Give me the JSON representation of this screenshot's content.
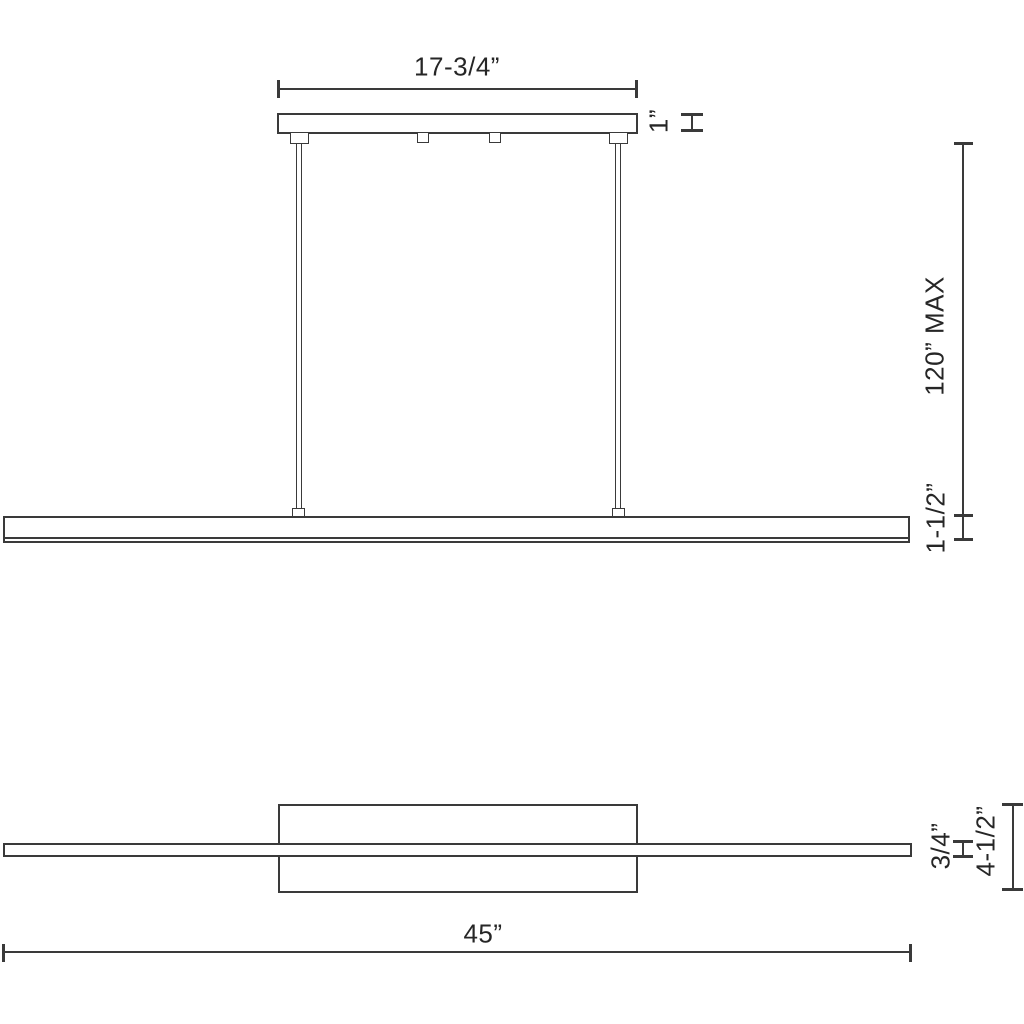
{
  "drawing": {
    "type": "linear-pendant-light-dimension-drawing",
    "stroke_color": "#3a3a3a",
    "text_color": "#262626",
    "background_color": "#ffffff"
  },
  "dimensions": {
    "canopy_width": "17-3/4”",
    "canopy_height": "1”",
    "suspension_max": "120” MAX",
    "fixture_height": "1-1/2”",
    "bar_thickness": "3/4”",
    "body_height": "4-1/2”",
    "fixture_length": "45”"
  }
}
